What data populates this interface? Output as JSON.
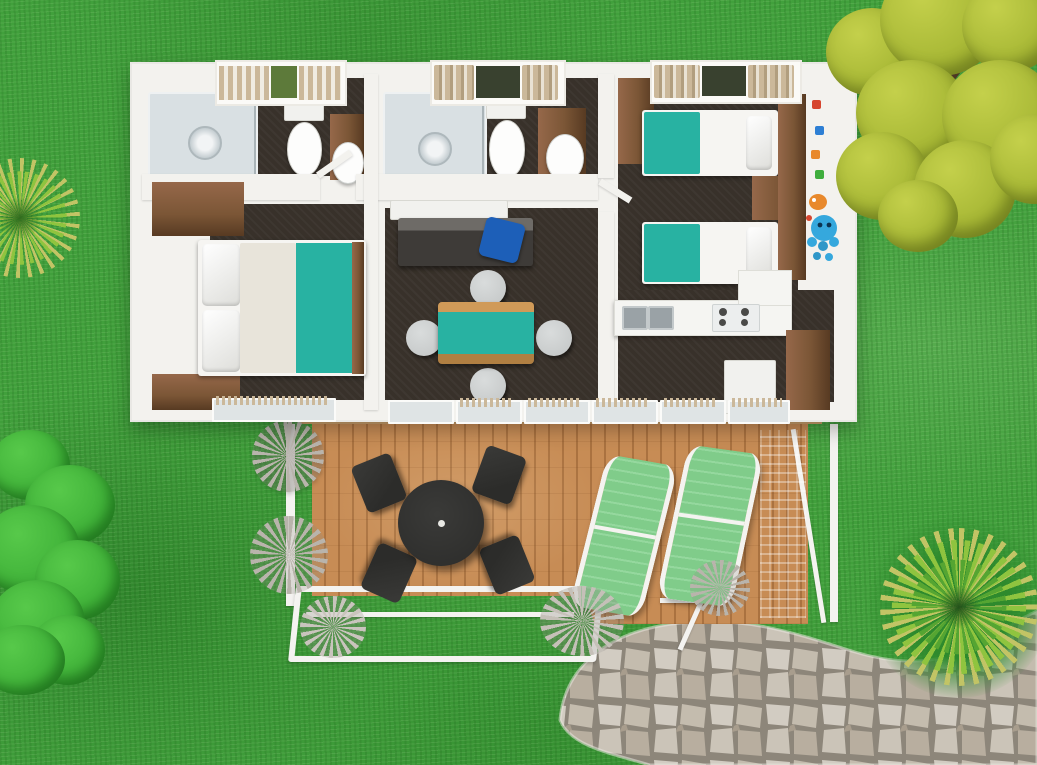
{
  "meta": {
    "title": "Holiday mobile home - 3D top-view floor plan on lawn",
    "canvas": {
      "width": 1037,
      "height": 765
    }
  },
  "colors": {
    "grass": "#41a03c",
    "grassDark": "#2e8a2d",
    "wall": "#f3f2ee",
    "floorDark": "#38312a",
    "teal": "#28b2a2",
    "wood": "#7b5636",
    "woodDark": "#573a22",
    "woodLight": "#96684a",
    "deckWood": "#c78c55",
    "deckWoodDark": "#aa7240",
    "deckSill": "#caa06c",
    "stoneJoint": "#8d867a",
    "lounger": "#80cc8a",
    "loungerLight": "#95d89e",
    "white": "#f4f3f0",
    "treeYellow": "#a3b432",
    "treeYellowLight": "#c4d04b",
    "branch": "#4d3823",
    "bush": "#3cae36",
    "bushLight": "#57c94a",
    "palm": "#55a532",
    "palmLight": "#8fc43f",
    "palmTip": "#c2c465",
    "blue": "#1d5fb8",
    "sofa": "#3e3b38",
    "sofaLight": "#6e6b67",
    "glass": "#dfe4e5",
    "showerGlass": "#d9e0e3",
    "steel": "#9aa2a6",
    "curtain": "#cbb89a",
    "curtainDark": "#b19e7f",
    "windowDark": "#39412f",
    "chairGray": "#c9cccc",
    "black": "#2c2c2a",
    "tableBlack": "#3a3a38",
    "agave": "#b9b4ac"
  },
  "scene": {
    "environment": {
      "ground": "lawn-grass",
      "vegetation": [
        {
          "name": "large-yellow-green-tree",
          "position": "top-right"
        },
        {
          "name": "yucca-plant",
          "position": "middle-left"
        },
        {
          "name": "green-bush-cluster",
          "position": "bottom-left"
        },
        {
          "name": "yucca-plant",
          "position": "bottom-right"
        }
      ],
      "hardscape": [
        {
          "name": "flagstone-path",
          "position": "bottom-right"
        }
      ]
    },
    "house": {
      "rooms": [
        {
          "name": "bathroom-1",
          "furniture": [
            "shower-cabin",
            "toilet",
            "washbasin-on-wood-cabinet",
            "slatted-window-blind"
          ]
        },
        {
          "name": "bathroom-2",
          "furniture": [
            "shower-cabin",
            "toilet",
            "washbasin-on-wood-cabinet",
            "window-with-curtains"
          ]
        },
        {
          "name": "master-bedroom",
          "furniture": [
            "double-bed-teal-runner",
            "wood-wardrobe",
            "wood-cabinet",
            "window-with-blind"
          ]
        },
        {
          "name": "living-dining-room",
          "furniture": [
            "dark-sofa",
            "blue-cushion",
            "dining-table-teal-top",
            "four-gray-chairs",
            "sideboard"
          ]
        },
        {
          "name": "kids-twin-bedroom",
          "furniture": [
            "twin-bed-teal",
            "twin-bed-teal",
            "wood-wardrobe",
            "wood-nightstand",
            "wood-headboard-panel",
            "octopus-toy-decal",
            "window-with-curtains"
          ]
        },
        {
          "name": "kitchen",
          "furniture": [
            "white-counter-L",
            "double-steel-sink",
            "gas-hob-4-burners",
            "fridge",
            "tall-wood-pantry",
            "sliding-glass-doors"
          ]
        }
      ]
    },
    "deck": {
      "name": "wooden-terrace",
      "furniture": [
        "round-black-table",
        "four-black-chairs",
        "green-sun-lounger",
        "green-sun-lounger",
        "white-railing",
        "agave-plants"
      ]
    }
  }
}
